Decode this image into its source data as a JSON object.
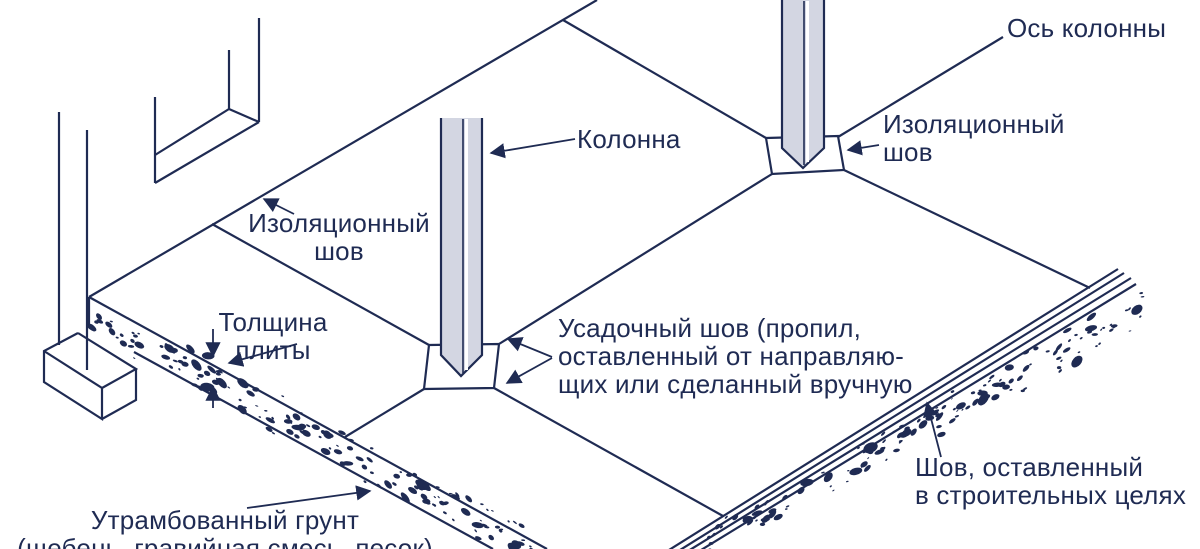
{
  "labels": {
    "column_axis": "Ось колонны",
    "column": "Колонна",
    "isolation_joint_right_l1": "Изоляционный",
    "isolation_joint_right_l2": "шов",
    "isolation_joint_left_l1": "Изоляционный",
    "isolation_joint_left_l2": "шов",
    "slab_thickness_l1": "Толщина",
    "slab_thickness_l2": "плиты",
    "shrinkage_joint_l1": "Усадочный шов (пропил,",
    "shrinkage_joint_l2": "оставленный от направляю-",
    "shrinkage_joint_l3": "щих или сделанный вручную",
    "construction_joint_l1": "Шов, оставленный",
    "construction_joint_l2": "в строительных целях",
    "compacted_soil_l1": "Утрамбованный грунт",
    "compacted_soil_l2": "(щебень, гравийная смесь, песок)"
  },
  "colors": {
    "ink": "#1f2b53",
    "column_fill": "#d3d6e2",
    "background": "#ffffff"
  }
}
